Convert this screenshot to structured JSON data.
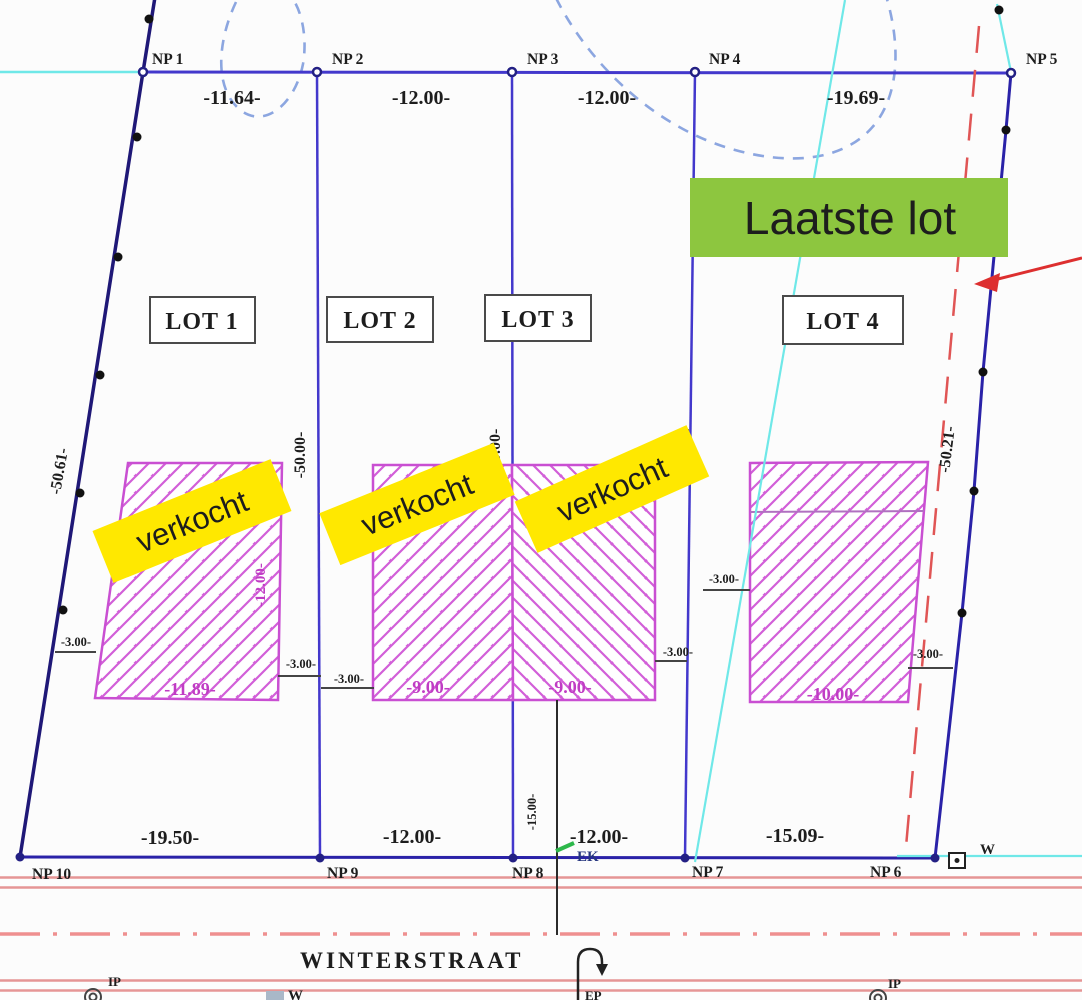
{
  "survey_points": {
    "np1": "NP 1",
    "np2": "NP 2",
    "np3": "NP 3",
    "np4": "NP 4",
    "np5": "NP 5",
    "np6": "NP 6",
    "np7": "NP 7",
    "np8": "NP 8",
    "np9": "NP 9",
    "np10": "NP 10"
  },
  "dimensions": {
    "top": [
      "-11.64-",
      "-12.00-",
      "-12.00-",
      "-19.69-"
    ],
    "bottom": [
      "-19.50-",
      "-12.00-",
      "-12.00-",
      "-15.09-"
    ],
    "left_side": "-50.61-",
    "right_side": "-50.21-",
    "lot12_depth": "-50.00-",
    "lot23_depth": "-50.00-",
    "lot34_depth": "-50.00-",
    "setback": "-3.00-",
    "depth_to_street": "-15.00-",
    "footprint_lot1_width": "-11.89-",
    "footprint_lot1_depth": "-12.00-",
    "footprint_lot2_width": "-9.00-",
    "footprint_lot3_width": "-9.00-",
    "footprint_lot4_width": "-10.00-"
  },
  "lots": {
    "lot1": "LOT 1",
    "lot2": "LOT 2",
    "lot3": "LOT 3",
    "lot4": "LOT 4"
  },
  "annotations": {
    "sold": "verkocht",
    "last_lot": "Laatste lot"
  },
  "street": {
    "name": "WINTERSTRAAT",
    "ek_label": "EK",
    "w_label": "W",
    "ip_label": "IP",
    "ep_label": "EP"
  },
  "colors": {
    "boundary_navy": "#211a7e",
    "lot_line_blue": "#4338cc",
    "footprint_magenta": "#c94fd2",
    "dim_magenta": "#c03cc4",
    "annotation_yellow": "#ffe800",
    "annotation_green": "#8dc63f",
    "street_pink": "#e59595",
    "red_dashed": "#e05555",
    "red_arrow": "#dd2f2f",
    "cyan": "#6fe8e8",
    "sketch_blue_dashed": "#8ca6e0"
  }
}
